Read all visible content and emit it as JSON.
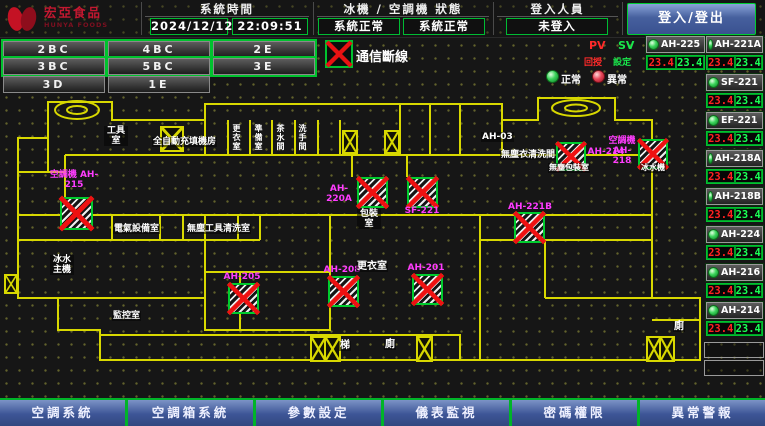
{
  "header": {
    "logo_text": "宏亞食品",
    "logo_subtext": "HUNYA FOODS",
    "system_time_label": "系統時間",
    "date": "2024/12/12",
    "time": "22:09:51",
    "status_label": "冰機 / 空調機 狀態",
    "chiller_status": "系統正常",
    "ac_status": "系統正常",
    "login_label": "登入人員",
    "login_status": "未登入",
    "login_button": "登入/登出"
  },
  "floors": {
    "buttons": [
      {
        "label": "2BC",
        "selected": true
      },
      {
        "label": "4BC",
        "selected": true
      },
      {
        "label": "2E",
        "selected": true
      },
      {
        "label": "3BC",
        "selected": true
      },
      {
        "label": "5BC",
        "selected": true
      },
      {
        "label": "3E",
        "selected": true
      },
      {
        "label": "3D",
        "selected": false
      },
      {
        "label": "1E",
        "selected": false
      }
    ]
  },
  "legend": {
    "comm_loss": "通信斷線",
    "normal": "正常",
    "abnormal": "異常",
    "pv": "PV",
    "sv": "SV",
    "pv_sub": "回授",
    "sv_sub": "設定"
  },
  "equipment": [
    {
      "name": "AH-225",
      "pv": "23.4",
      "sv": "23.4"
    },
    {
      "name": "AH-221A",
      "pv": "23.4",
      "sv": "23.4"
    },
    {
      "name": "SF-221",
      "pv": "23.4",
      "sv": "23.4"
    },
    {
      "name": "EF-221",
      "pv": "23.4",
      "sv": "23.4"
    },
    {
      "name": "AH-218A",
      "pv": "23.4",
      "sv": "23.4"
    },
    {
      "name": "AH-218B",
      "pv": "23.4",
      "sv": "23.4"
    },
    {
      "name": "AH-224",
      "pv": "23.4",
      "sv": "23.4"
    },
    {
      "name": "AH-216",
      "pv": "23.4",
      "sv": "23.4"
    },
    {
      "name": "AH-214",
      "pv": "23.4",
      "sv": "23.4"
    }
  ],
  "floorplan": {
    "units": [
      "空調機 AH-215",
      "AH-205",
      "AH-208",
      "AH-201",
      "AH-220A",
      "SF-221",
      "AH-221B",
      "AH-214",
      "空調機 AH-218"
    ],
    "rooms": [
      "工具室",
      "全自動充填機房",
      "AH-03",
      "無塵衣清洗間",
      "更衣室",
      "電氣設備室",
      "無塵工具清洗室",
      "冰水 主機",
      "監控室",
      "包裝室",
      "無塵包裝室",
      "冰水機",
      "梯",
      "廁",
      "廁",
      "更衣室",
      "準備室",
      "茶水間",
      "洗手間"
    ]
  },
  "footer": {
    "buttons": [
      "空調系統",
      "空調箱系統",
      "參數設定",
      "儀表監視",
      "密碼權限",
      "異常警報"
    ]
  }
}
